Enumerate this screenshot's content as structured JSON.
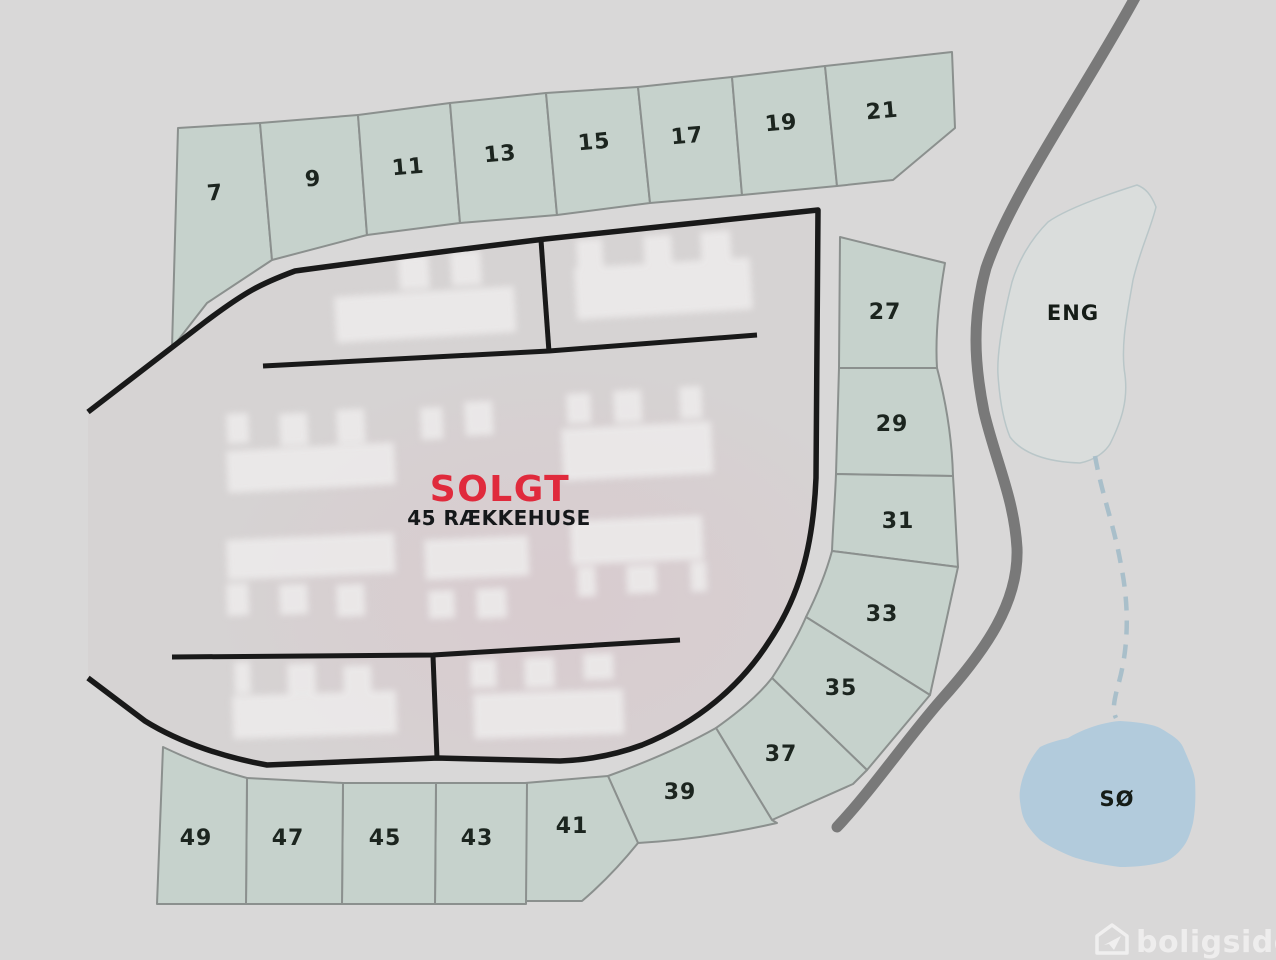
{
  "site_plan": {
    "center_zone": {
      "status_label": "SOLGT",
      "subtitle": "45 RÆKKEHUSE"
    },
    "plots": [
      {
        "number": "7"
      },
      {
        "number": "9"
      },
      {
        "number": "11"
      },
      {
        "number": "13"
      },
      {
        "number": "15"
      },
      {
        "number": "17"
      },
      {
        "number": "19"
      },
      {
        "number": "21"
      },
      {
        "number": "27"
      },
      {
        "number": "29"
      },
      {
        "number": "31"
      },
      {
        "number": "33"
      },
      {
        "number": "35"
      },
      {
        "number": "37"
      },
      {
        "number": "39"
      },
      {
        "number": "41"
      },
      {
        "number": "43"
      },
      {
        "number": "45"
      },
      {
        "number": "47"
      },
      {
        "number": "49"
      }
    ],
    "areas": {
      "meadow_label": "ENG",
      "lake_label": "SØ"
    },
    "watermark": {
      "brand": "boligsiden"
    },
    "colors": {
      "background": "#d9d8d8",
      "center_zone_fill": "#d6d3d3",
      "plot_fill": "#c6d2cc",
      "plot_border": "#8b908e",
      "road_dark": "#191919",
      "road_gray": "#797979",
      "meadow_fill": "#dadedd",
      "meadow_border": "#b9c6c8",
      "lake_fill": "#b2cbdc",
      "stream": "#a9bfca",
      "label": "#1c251f",
      "sold_red": "#e02a3c",
      "watermark": "rgba(255,255,255,0.55)"
    }
  }
}
